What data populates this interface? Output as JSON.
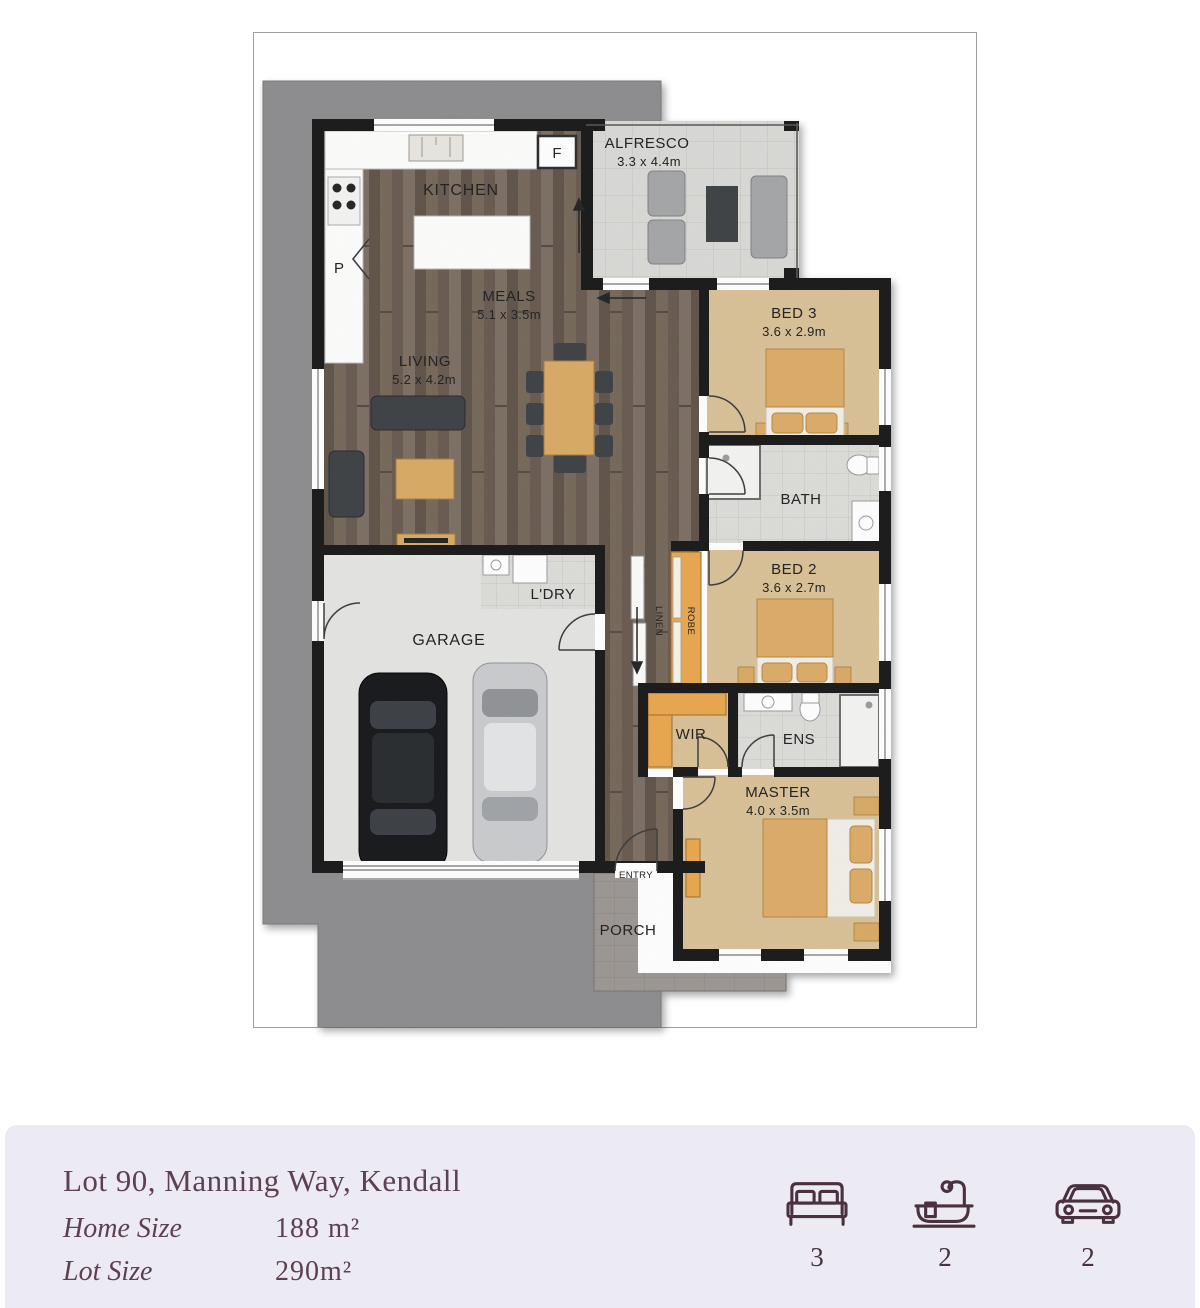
{
  "plan": {
    "labels": {
      "alfresco": "ALFRESCO",
      "alfresco_dims": "3.3 x 4.4m",
      "kitchen": "KITCHEN",
      "meals": "MEALS",
      "meals_dims": "5.1 x 3.5m",
      "living": "LIVING",
      "living_dims": "5.2 x 4.2m",
      "bed3": "BED 3",
      "bed3_dims": "3.6 x 2.9m",
      "bath": "BATH",
      "bed2": "BED 2",
      "bed2_dims": "3.6 x 2.7m",
      "linen": "LINEN",
      "robe": "ROBE",
      "garage": "GARAGE",
      "ldry": "L'DRY",
      "wir": "WIR",
      "ens": "ENS",
      "master": "MASTER",
      "master_dims": "4.0 x 3.5m",
      "entry": "ENTRY",
      "porch": "PORCH",
      "pantry": "P",
      "fridge": "F"
    }
  },
  "footer": {
    "address": "Lot 90, Manning Way, Kendall",
    "home_size_label": "Home Size",
    "home_size_value": "188 m²",
    "lot_size_label": "Lot Size",
    "lot_size_value": "290m²",
    "stats": {
      "beds": "3",
      "baths": "2",
      "cars": "2"
    },
    "colors": {
      "background": "#ECEBF3",
      "text": "#5D4051",
      "icon": "#4A3140"
    }
  }
}
